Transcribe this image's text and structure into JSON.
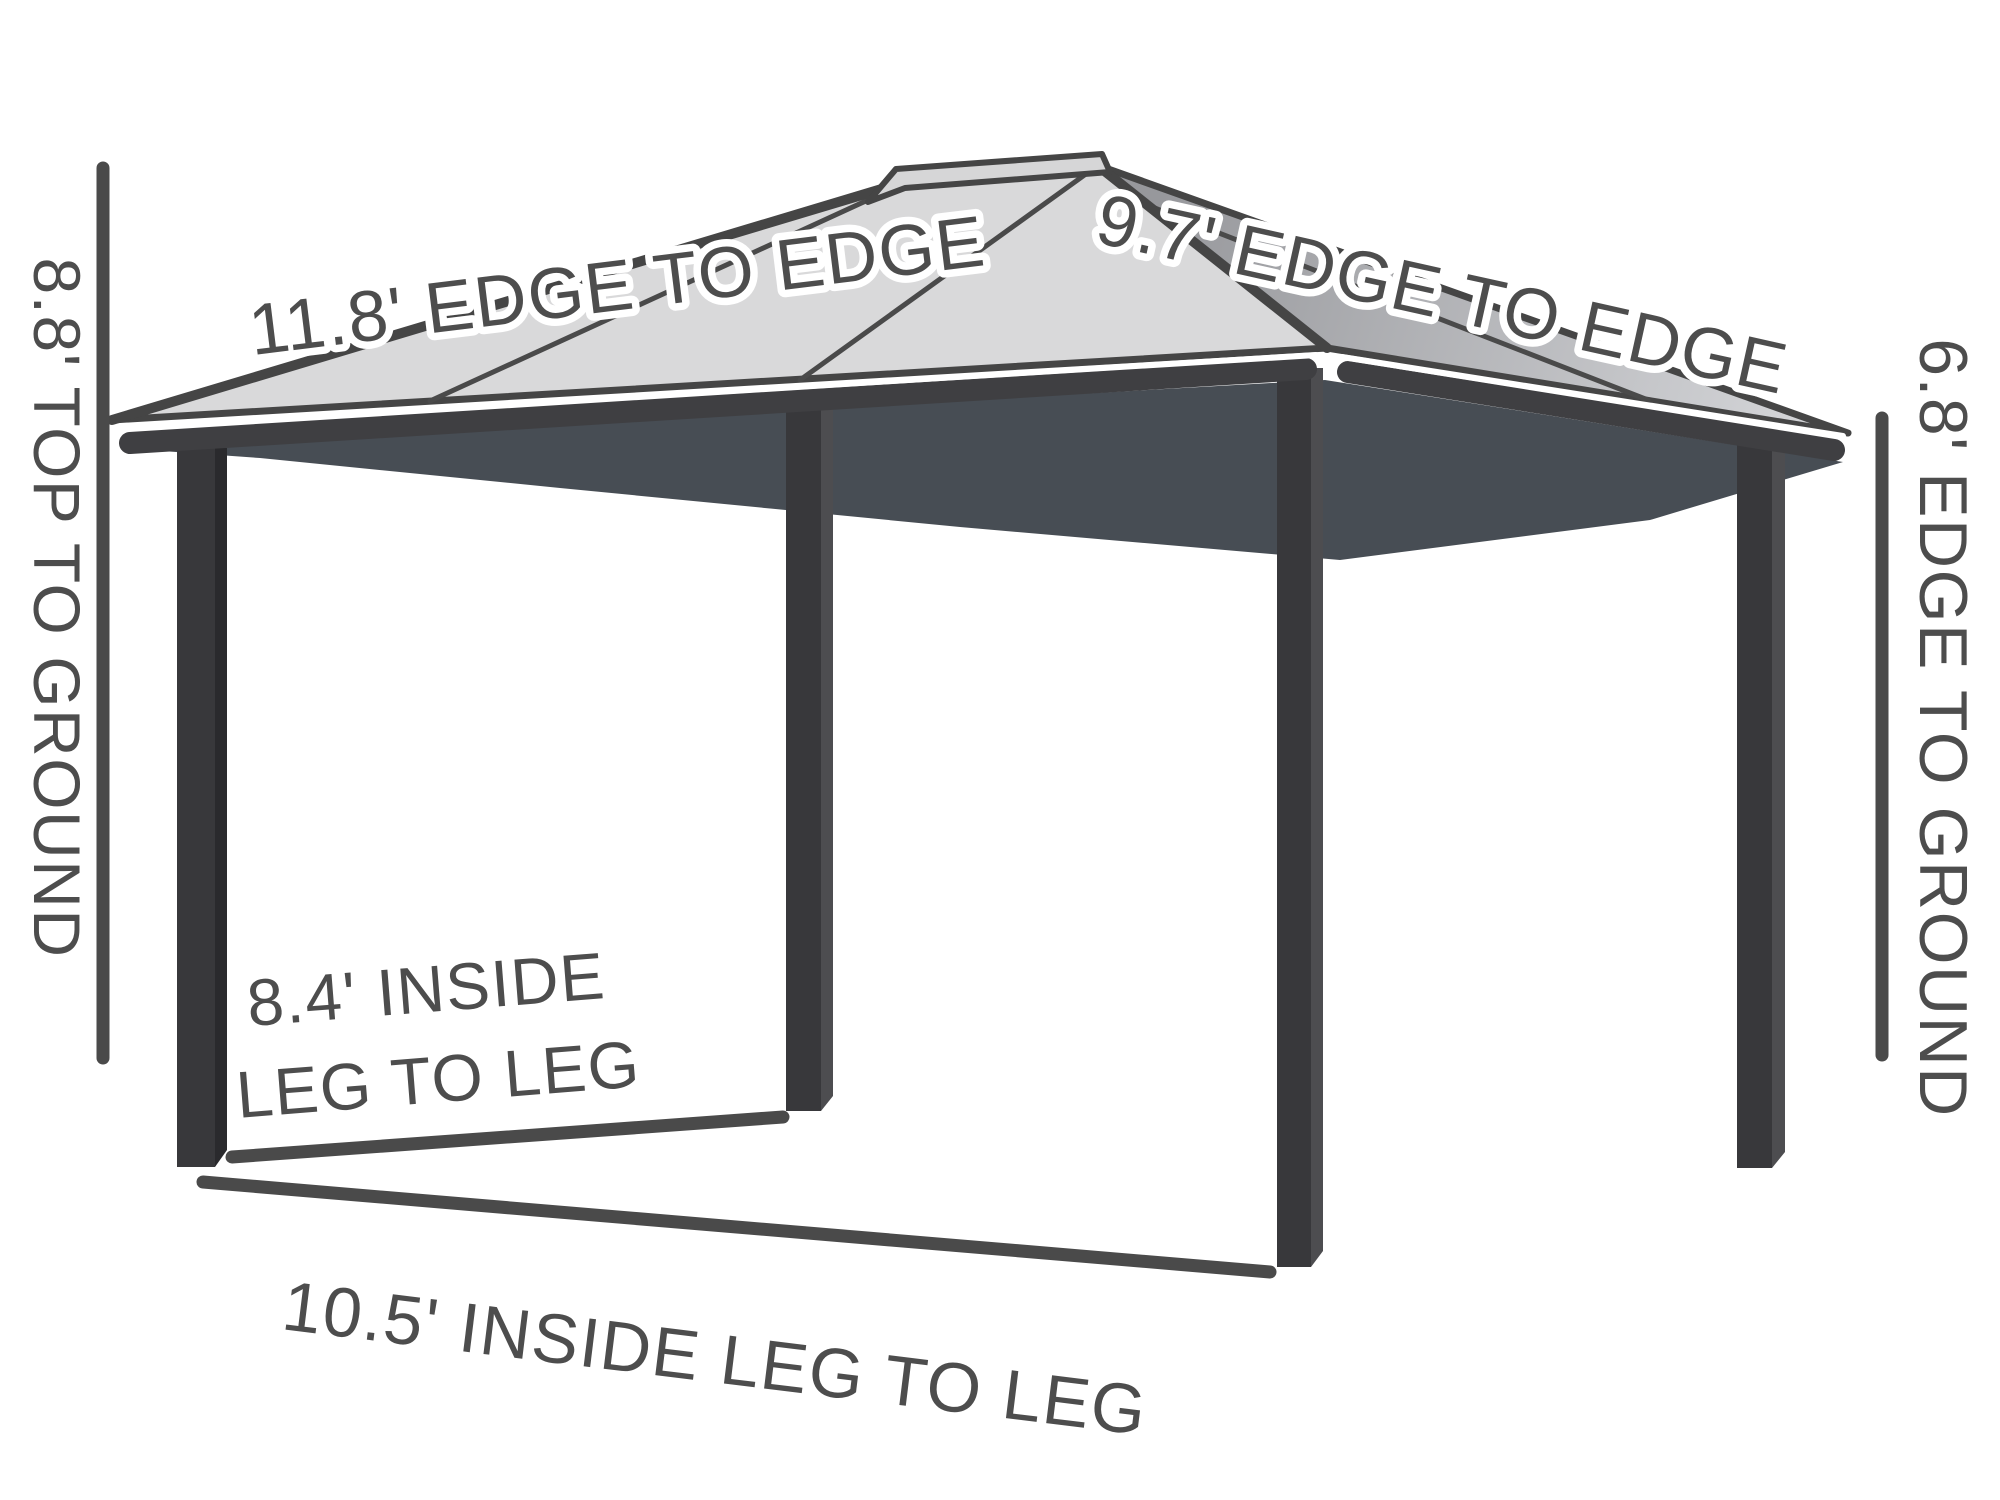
{
  "labels": {
    "roof_long_edge": "11.8' EDGE TO EDGE",
    "roof_short_edge": "9.7' EDGE TO EDGE",
    "height_left": "8.8' TOP TO GROUND",
    "height_right": "6.8' EDGE TO GROUND",
    "inside_depth_line1": "8.4' INSIDE",
    "inside_depth_line2": "LEG TO LEG",
    "inside_width": "10.5' INSIDE LEG TO LEG"
  },
  "colors": {
    "background": "#ffffff",
    "outline": "#454545",
    "roof_left": "#d9d9da",
    "roof_right_dark": "#97989c",
    "roof_right_light": "#d2d3d6",
    "ridge_cap": "#d6d6d7",
    "ceiling": "#474d54",
    "leg_face": "#38383b",
    "leg_side_dark": "#2a2a2d",
    "leg_side_light": "#4d4d50",
    "fascia": "#3f3f42",
    "dimension_line": "#4a4a4a",
    "label_text": "#4d4d4d",
    "label_outline": "#ffffff"
  }
}
